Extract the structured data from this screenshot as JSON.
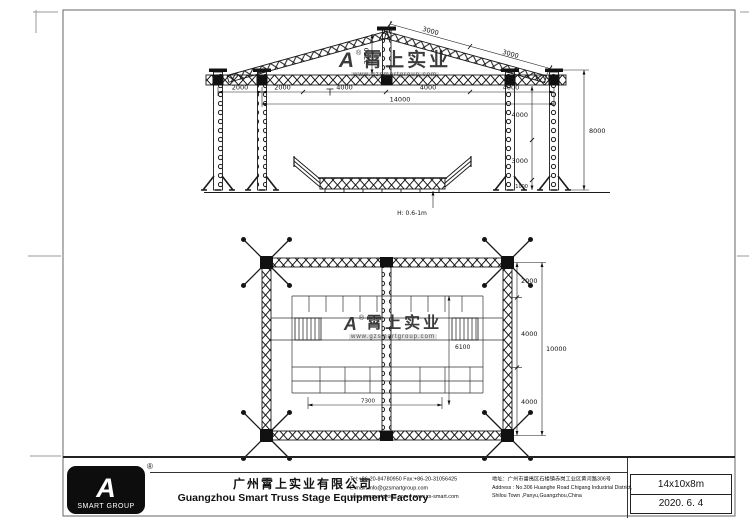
{
  "watermark": {
    "mark": "A",
    "registered": "®",
    "brand": "霄上实业",
    "url": "www.gzsmartgroup.com"
  },
  "elevation": {
    "dims": {
      "left_bay": "2000",
      "seg1": "2000",
      "seg2": "4000",
      "seg3": "4000",
      "seg4": "4000",
      "total_width": "14000",
      "roof1": "3000",
      "roof2": "3000",
      "ridge": "2200",
      "col_upper": "4000",
      "col_mid": "3000",
      "col_base": "1000",
      "total_height": "8000",
      "stage_note": "H: 0.6-1m"
    }
  },
  "plan": {
    "dims": {
      "depth_top": "2000",
      "depth_mid": "4000",
      "depth_bottom": "4000",
      "total_depth": "10000",
      "stage_width": "7300",
      "stage_depth": "6100"
    }
  },
  "titleblock": {
    "logo_mark": "A",
    "logo_registered": "®",
    "logo_text": "SMART GROUP",
    "company_cn": "广州霄上实业有限公司",
    "company_en": "Guangzhou Smart Truss Stage Equipment Factory",
    "tel": "Tel:+86-20-84780950  Fax:+86-20-31056425",
    "email": "E-mail: info@gzsmartgroup.com",
    "web": "www.gzsmartgroup.com / www.xs-smart.com",
    "address_cn": "地址：广州市番禺区石楼镇赤岗工业区黄河路306号",
    "address_en1": "Address : No.306 Huanghe Road Chigang Industrial District,",
    "address_en2": "Shilou Town ,Panyu,Guangzhou,China",
    "size": "14x10x8m",
    "date": "2020. 6. 4"
  }
}
